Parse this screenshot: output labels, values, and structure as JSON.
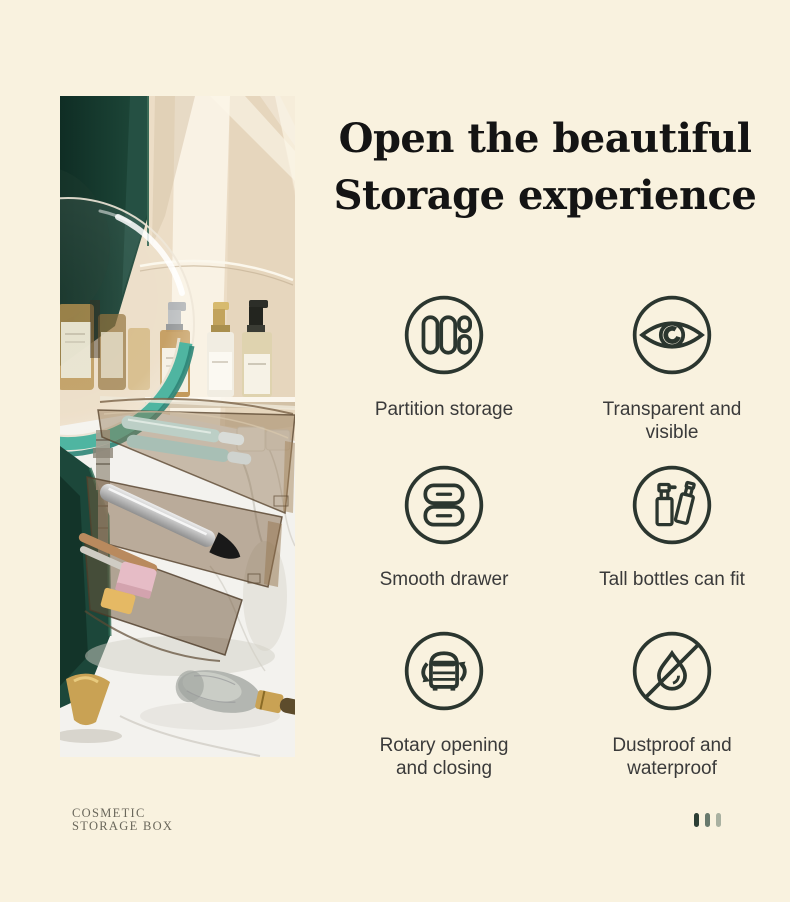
{
  "title": {
    "line1": "Open the beautiful",
    "line2": "Storage experience"
  },
  "features": [
    {
      "icon": "partition-storage-icon",
      "lines": [
        "Partition storage"
      ]
    },
    {
      "icon": "eye-icon",
      "lines": [
        "Transparent and",
        "visible"
      ]
    },
    {
      "icon": "drawer-icon",
      "lines": [
        "Smooth drawer"
      ]
    },
    {
      "icon": "bottles-icon",
      "lines": [
        "Tall bottles can fit"
      ]
    },
    {
      "icon": "rotary-icon",
      "lines": [
        "Rotary opening",
        "and closing"
      ]
    },
    {
      "icon": "waterproof-icon",
      "lines": [
        "Dustproof and",
        "waterproof"
      ]
    }
  ],
  "footer": {
    "brand_line1": "COSMETIC",
    "brand_line2": "STORAGE BOX"
  },
  "pagination": {
    "colors": [
      "#2c3e34",
      "#68796c",
      "#a9b1a1"
    ]
  },
  "colors": {
    "background": "#f9f2df",
    "title_text": "#141414",
    "label_text": "#3a3a3a",
    "icon_stroke": "#2b362f",
    "brand_text": "#6a675b",
    "accent_teal": "#4fb5a1",
    "box_green": "#1c473a",
    "gold": "#c9a254"
  }
}
